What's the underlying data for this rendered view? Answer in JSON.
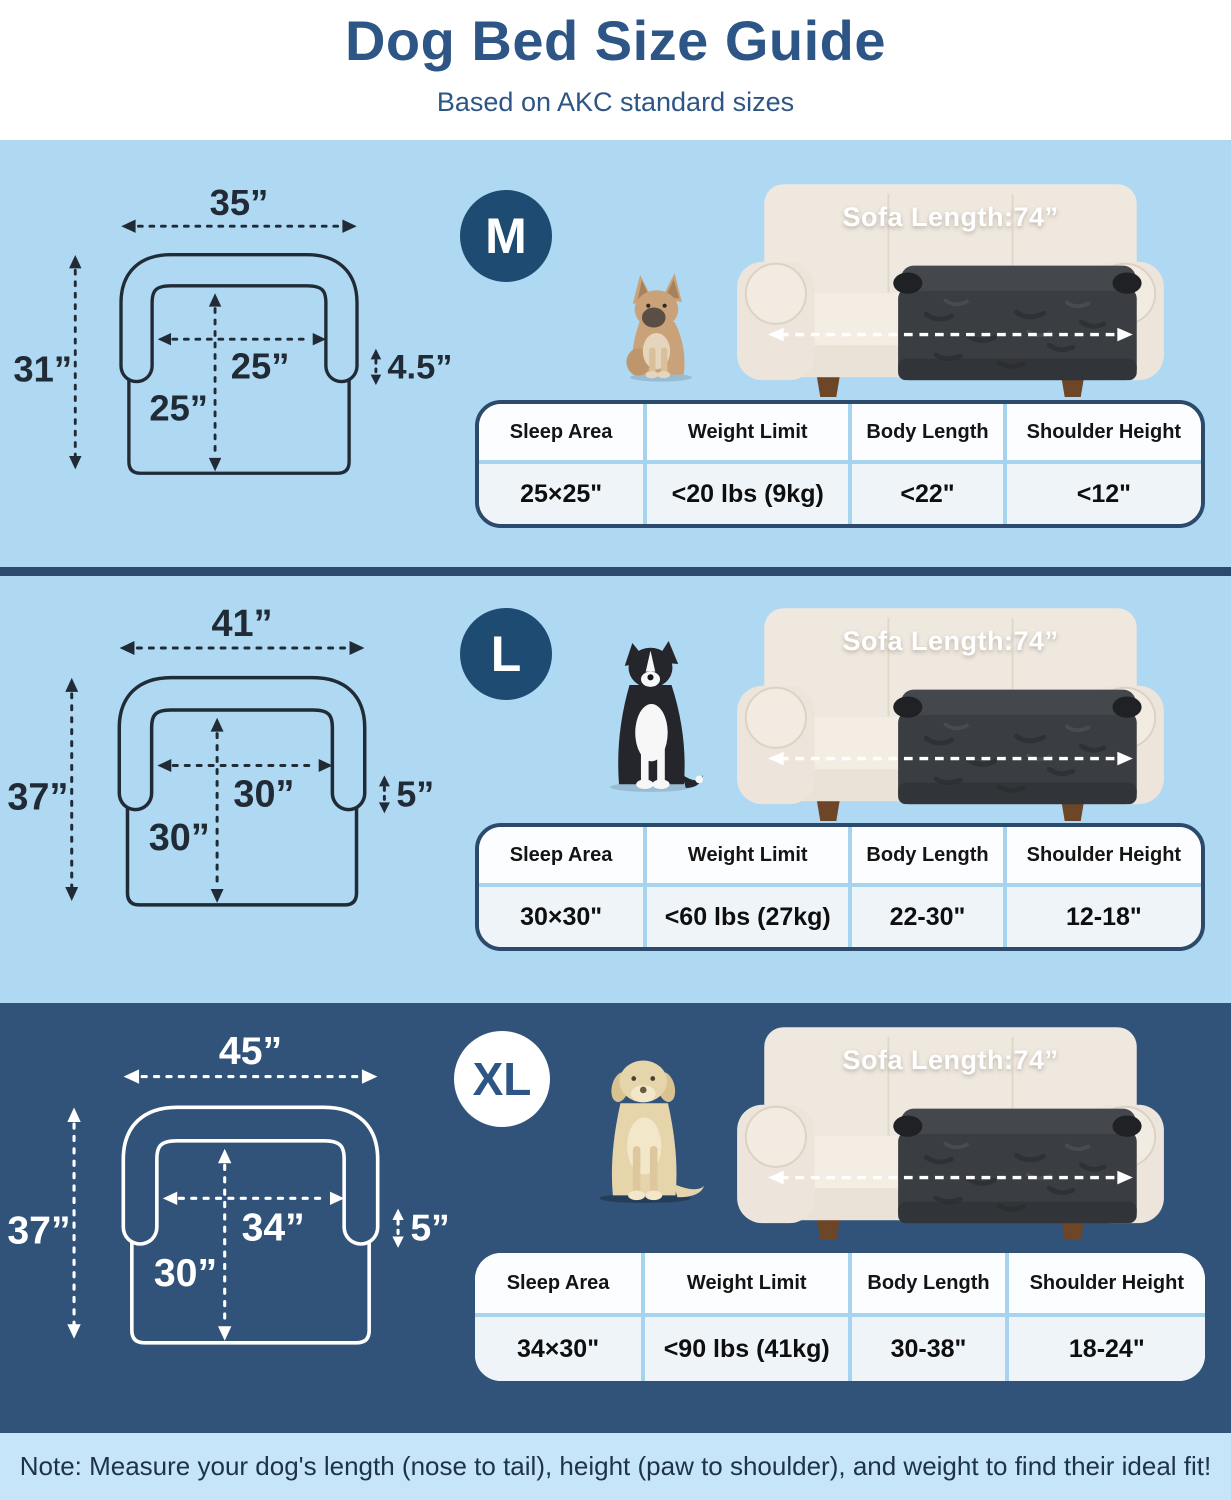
{
  "header": {
    "title": "Dog Bed Size Guide",
    "subtitle": "Based on AKC standard sizes"
  },
  "table_headers": [
    "Sleep Area",
    "Weight Limit",
    "Body Length",
    "Shoulder Height"
  ],
  "sofa": {
    "label": "Sofa Length:74”"
  },
  "sizes": [
    {
      "badge": "M",
      "dog": "french-bulldog",
      "diagram": {
        "outer_width": "35”",
        "outer_height": "31”",
        "inner_width": "25”",
        "inner_height": "25”",
        "bolster_height": "4.5”"
      },
      "table": {
        "sleep_area": "25×25\"",
        "weight_limit": "<20 lbs (9kg)",
        "body_length": "<22\"",
        "shoulder_height": "<12\""
      }
    },
    {
      "badge": "L",
      "dog": "border-collie",
      "diagram": {
        "outer_width": "41”",
        "outer_height": "37”",
        "inner_width": "30”",
        "inner_height": "30”",
        "bolster_height": "5”"
      },
      "table": {
        "sleep_area": "30×30\"",
        "weight_limit": "<60 lbs (27kg)",
        "body_length": "22-30\"",
        "shoulder_height": "12-18\""
      }
    },
    {
      "badge": "XL",
      "dog": "labrador",
      "diagram": {
        "outer_width": "45”",
        "outer_height": "37”",
        "inner_width": "34”",
        "inner_height": "30”",
        "bolster_height": "5”"
      },
      "table": {
        "sleep_area": "34×30\"",
        "weight_limit": "<90 lbs (41kg)",
        "body_length": "30-38\"",
        "shoulder_height": "18-24\""
      }
    }
  ],
  "note": "Note: Measure your dog's length (nose to tail), height (paw to shoulder), and weight to find their ideal fit!",
  "colors": {
    "title_navy": "#2D5585",
    "light_section_bg": "#AFD8F2",
    "dark_section_bg": "#315379",
    "divider_navy": "#2C4A6C",
    "badge_navy": "#1E4B71",
    "badge_text": "#FFFFFF",
    "footer_bg": "#C6E5F8",
    "note_text": "#1E3347",
    "table_border": "#2C4A6C",
    "table_divider": "#A6D4EE",
    "diagram_line": "#202B36",
    "diagram_line_dark_section": "#FFFFFF",
    "sofa_cream": "#EFE8DF",
    "dog_bed_fur": "#3A3D41"
  }
}
